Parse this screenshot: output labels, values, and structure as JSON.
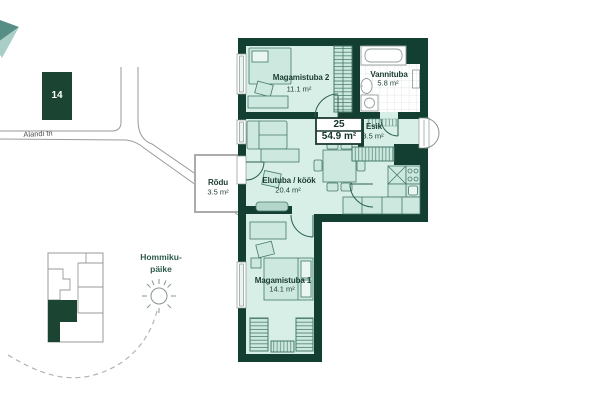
{
  "site_map": {
    "building_number": "14",
    "street_name": "Alandi tn"
  },
  "orientation_note": {
    "line1": "Hommiku-",
    "line2": "päike"
  },
  "apartment": {
    "number": "25",
    "total_area": "54.9 m²"
  },
  "rooms": {
    "bedroom2": {
      "name": "Magamistuba 2",
      "area": "11.1 m²"
    },
    "bathroom": {
      "name": "Vannituba",
      "area": "5.8 m²"
    },
    "hall": {
      "name": "Esik",
      "area": "3.5 m²"
    },
    "living_kitchen": {
      "name": "Elutuba / köök",
      "area": "20.4 m²"
    },
    "balcony": {
      "name": "Rõdu",
      "area": "3.5 m²"
    },
    "bedroom1": {
      "name": "Magamistuba 1",
      "area": "14.1 m²"
    }
  },
  "colors": {
    "wall": "#133e32",
    "room_fill": "#d8efe7",
    "furniture_fill": "#cde9df",
    "furniture_line": "#45786a",
    "map_line": "#9a9a9a",
    "highlight": "#1c4433"
  }
}
